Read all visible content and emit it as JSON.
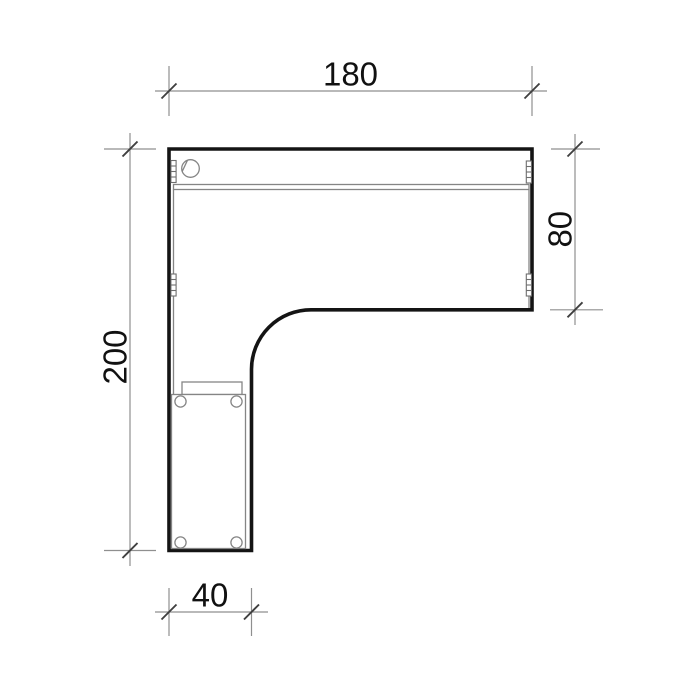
{
  "drawing": {
    "type": "technical-plan-drawing",
    "subject": "L-shaped corner desk, top view with pedestal, cable grommet, back rail and connector marks",
    "dimensions": {
      "top": {
        "label": "180"
      },
      "right": {
        "label": "80"
      },
      "left": {
        "label": "200"
      },
      "bottom": {
        "label": "40"
      }
    },
    "colors": {
      "background": "#ffffff",
      "outline": "#141414",
      "detail_lines": "#858585",
      "dimension_lines": "#8f8f8f",
      "tick_marks": "#3f3f3f",
      "text": "#111111"
    }
  }
}
